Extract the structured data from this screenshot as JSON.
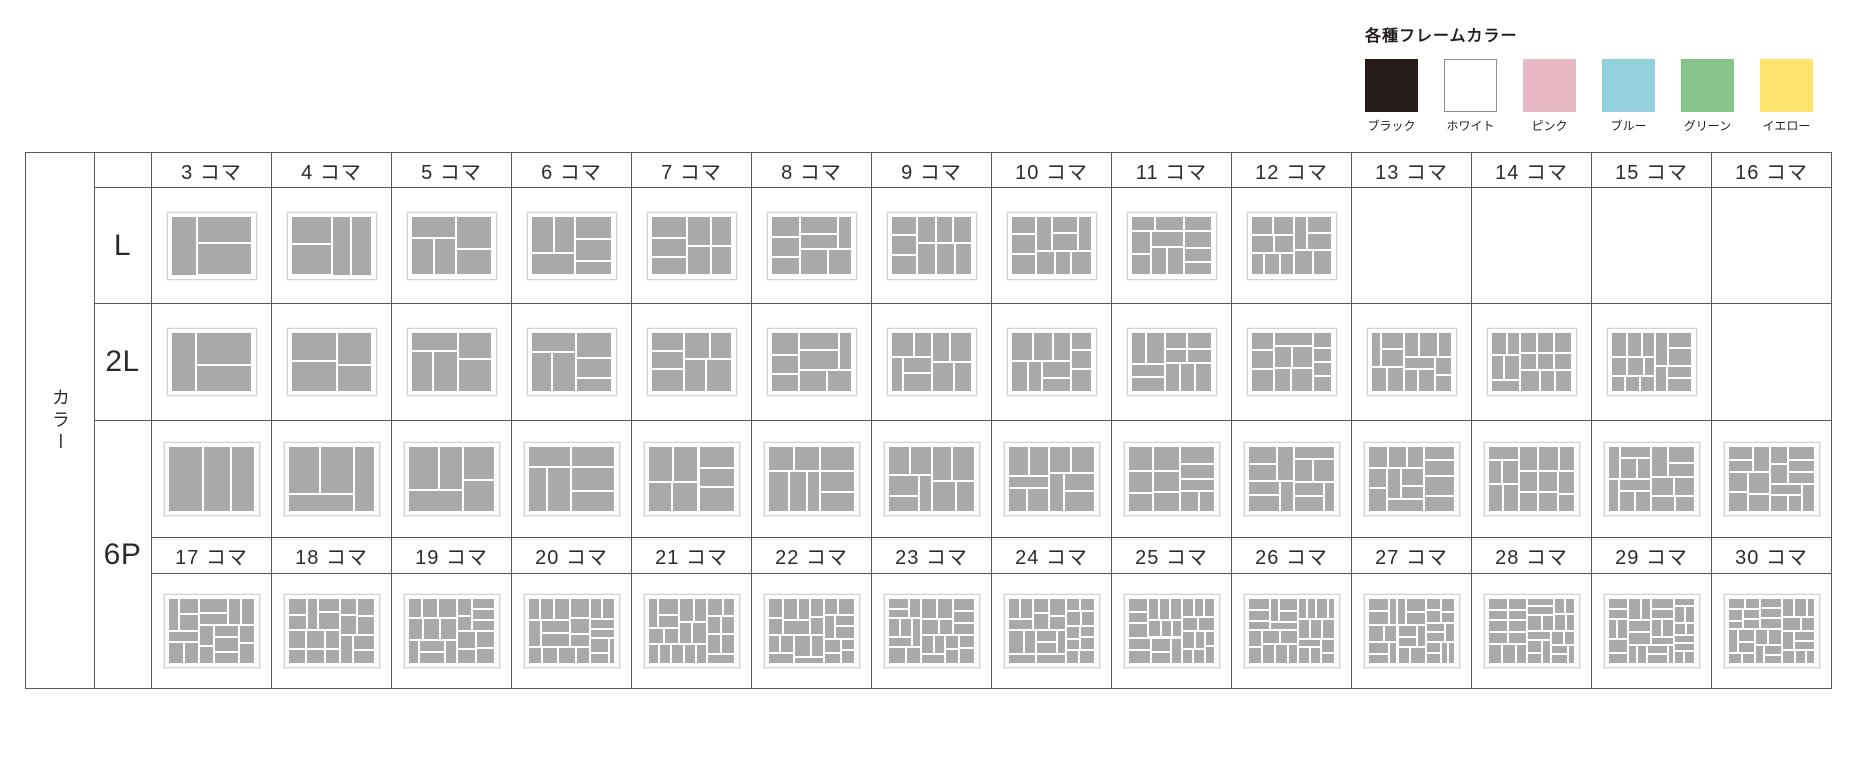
{
  "legend": {
    "title": "各種フレームカラー",
    "colors": [
      {
        "name": "ブラック",
        "hex": "#261b19"
      },
      {
        "name": "ホワイト",
        "hex": "#ffffff"
      },
      {
        "name": "ピンク",
        "hex": "#e6b9c4"
      },
      {
        "name": "ブルー",
        "hex": "#92d0da"
      },
      {
        "name": "グリーン",
        "hex": "#85c58a"
      },
      {
        "name": "イエロー",
        "hex": "#ffe470"
      }
    ]
  },
  "table": {
    "corner_label": "カラー",
    "row_labels": [
      "L",
      "2L",
      "6P"
    ],
    "frame_unit": "コマ",
    "header_row_1": [
      "3 コマ",
      "4 コマ",
      "5 コマ",
      "6 コマ",
      "7 コマ",
      "8 コマ",
      "9 コマ",
      "10 コマ",
      "11 コマ",
      "12 コマ",
      "13 コマ",
      "14 コマ",
      "15 コマ",
      "16 コマ"
    ],
    "header_row_2": [
      "17 コマ",
      "18 コマ",
      "19 コマ",
      "20 コマ",
      "21 コマ",
      "22 コマ",
      "23 コマ",
      "24 コマ",
      "25 コマ",
      "26 コマ",
      "27 コマ",
      "28 コマ",
      "29 コマ",
      "30 コマ"
    ],
    "cells": {
      "L": [
        3,
        4,
        5,
        6,
        7,
        8,
        9,
        10,
        11,
        12,
        null,
        null,
        null,
        null
      ],
      "2L": [
        3,
        4,
        5,
        6,
        7,
        8,
        9,
        10,
        11,
        12,
        13,
        14,
        15,
        null
      ],
      "6P_top": [
        3,
        4,
        5,
        6,
        7,
        8,
        9,
        10,
        11,
        12,
        13,
        14,
        15,
        16
      ],
      "6P_bottom": [
        17,
        18,
        19,
        20,
        21,
        22,
        23,
        24,
        25,
        26,
        27,
        28,
        29,
        30
      ]
    }
  },
  "style": {
    "block_color": "#a9a9aa",
    "grid_line_color": "#5d5856",
    "text_color": "#2f2a28"
  }
}
